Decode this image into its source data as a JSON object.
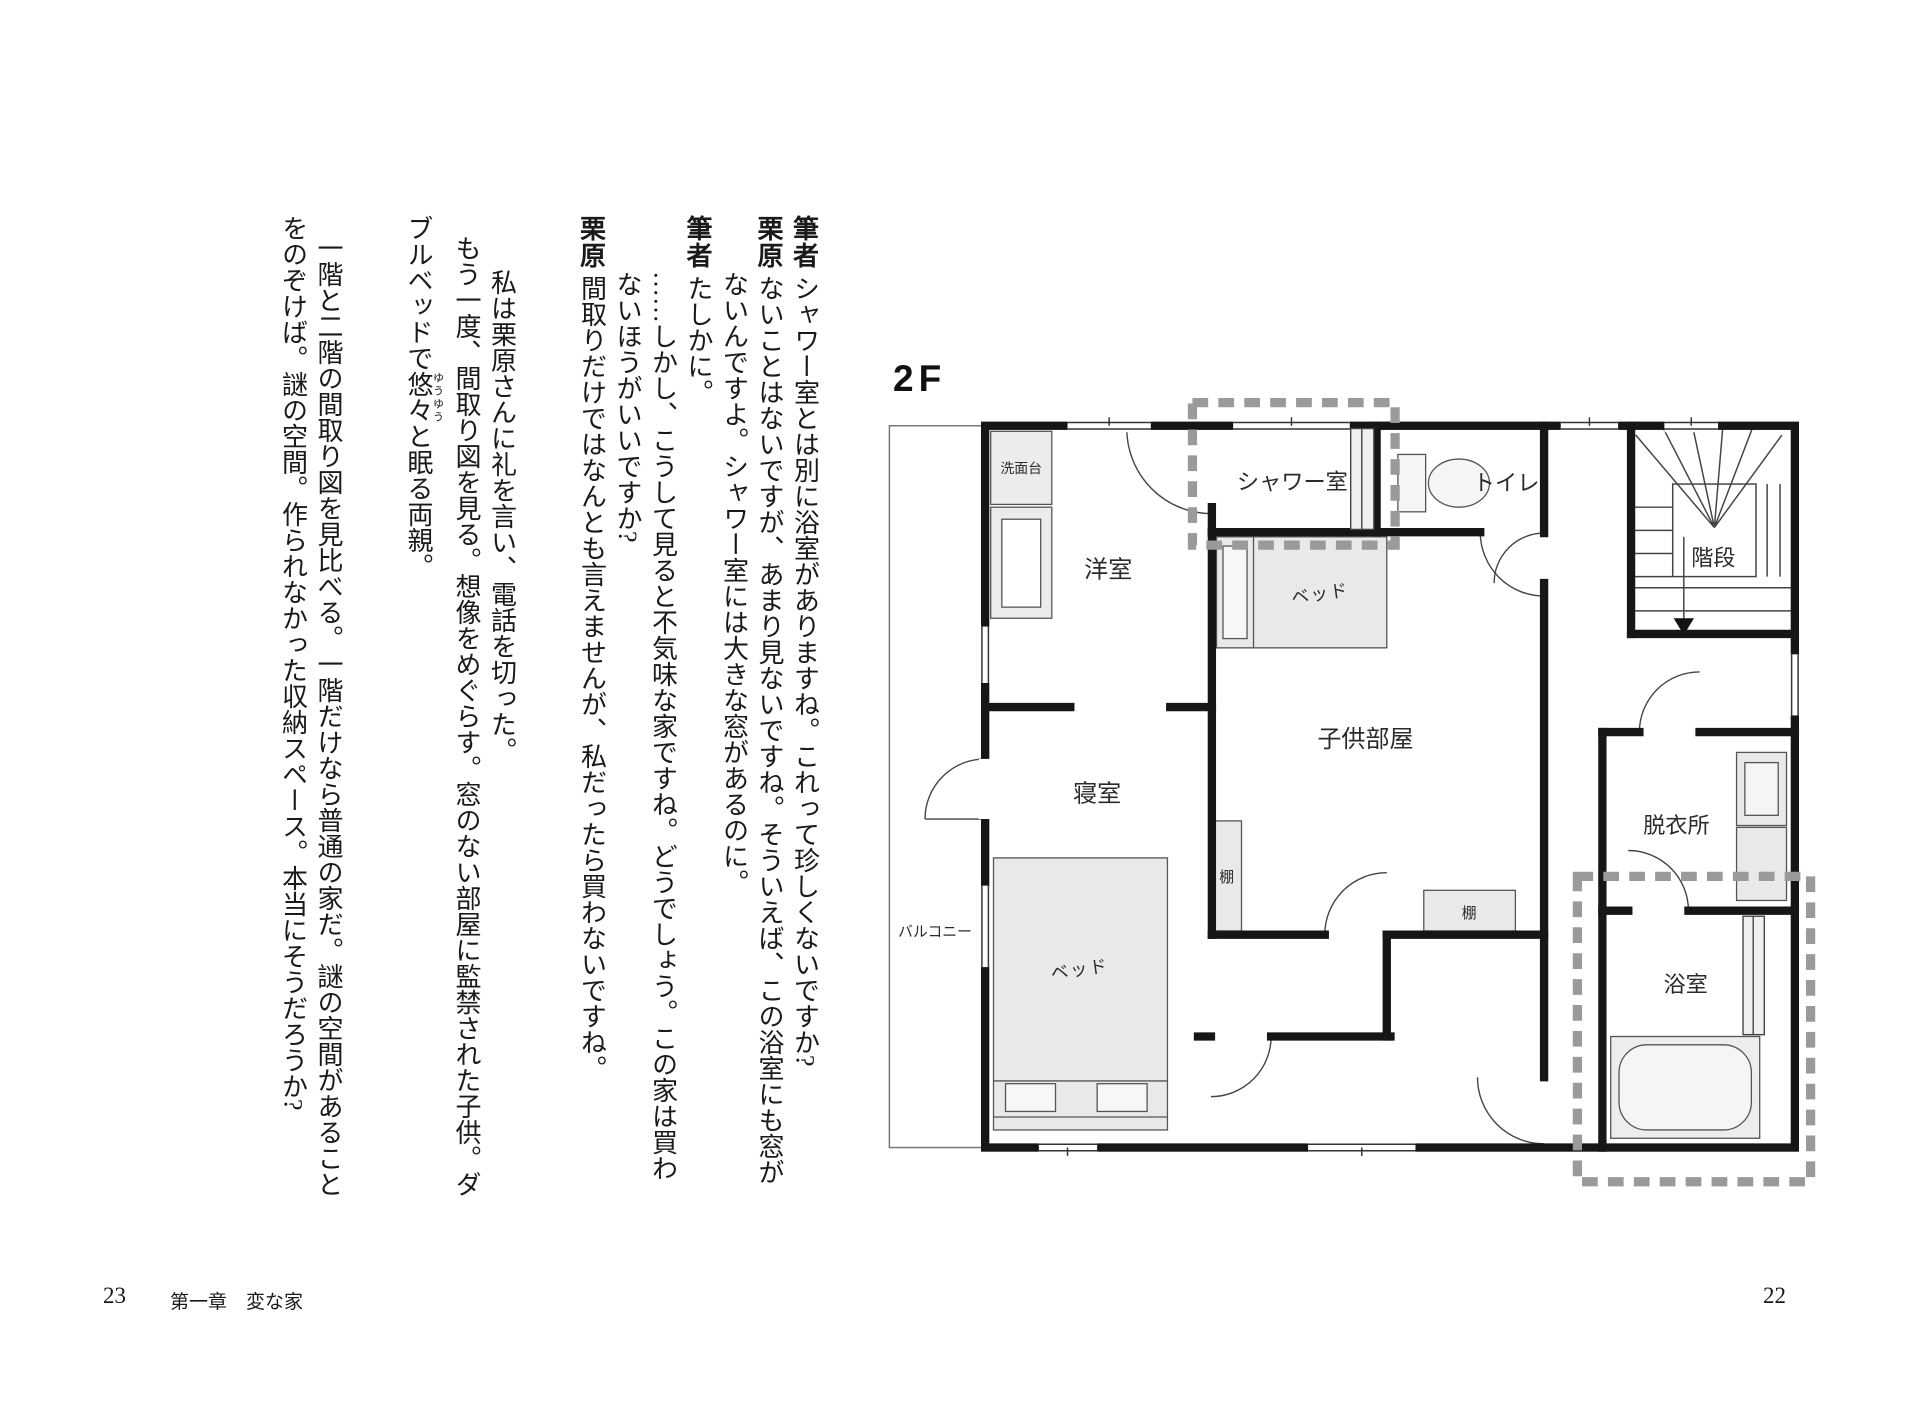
{
  "left_page": {
    "page_number": "23",
    "chapter_header": "第一章　変な家",
    "columns": [
      {
        "speaker": "筆者",
        "body": "シャワー室とは別に浴室がありますね。これって珍しくないですか?"
      },
      {
        "speaker": "栗原",
        "body": "ないことはないですが、あまり見ないですね。そういえば、この浴室にも窓が"
      },
      {
        "body": "ないんですよ。シャワー室には大きな窓があるのに。"
      },
      {
        "speaker": "筆者",
        "body": "たしかに。"
      },
      {
        "body": "……しかし、こうして見ると不気味な家ですね。どうでしょう。この家は買わ"
      },
      {
        "body": "ないほうがいいですか?"
      },
      {
        "speaker": "栗原",
        "body": "間取りだけではなんとも言えませんが、私だったら買わないですね。"
      },
      {
        "body": "私は栗原さんに礼を言い、電話を切った。"
      },
      {
        "body": "もう一度、間取り図を見る。想像をめぐらす。窓のない部屋に監禁された子供。ダ"
      },
      {
        "pre": "ブルベッドで",
        "ruby_base": "悠々",
        "ruby_text": "ゆうゆう",
        "post": "と眠る両親。"
      },
      {
        "body": "一階と二階の間取り図を見比べる。一階だけなら普通の家だ。謎の空間があること"
      },
      {
        "body": "をのぞけば。謎の空間。作られなかった収納スペース。本当にそうだろうか?"
      }
    ]
  },
  "right_page": {
    "page_number": "22",
    "floor_label": "2F",
    "plan": {
      "balcony": "バルコニー",
      "washstand": "洗面台",
      "western_room": "洋室",
      "shower_room": "シャワー室",
      "toilet": "トイレ",
      "stairs": "階段",
      "kids_bed": "ベッド",
      "kids_room": "子供部屋",
      "shelf_left": "棚",
      "shelf_right": "棚",
      "bedroom": "寝室",
      "main_bed": "ベッド",
      "dressing_room": "脱衣所",
      "bathroom": "浴室"
    }
  }
}
